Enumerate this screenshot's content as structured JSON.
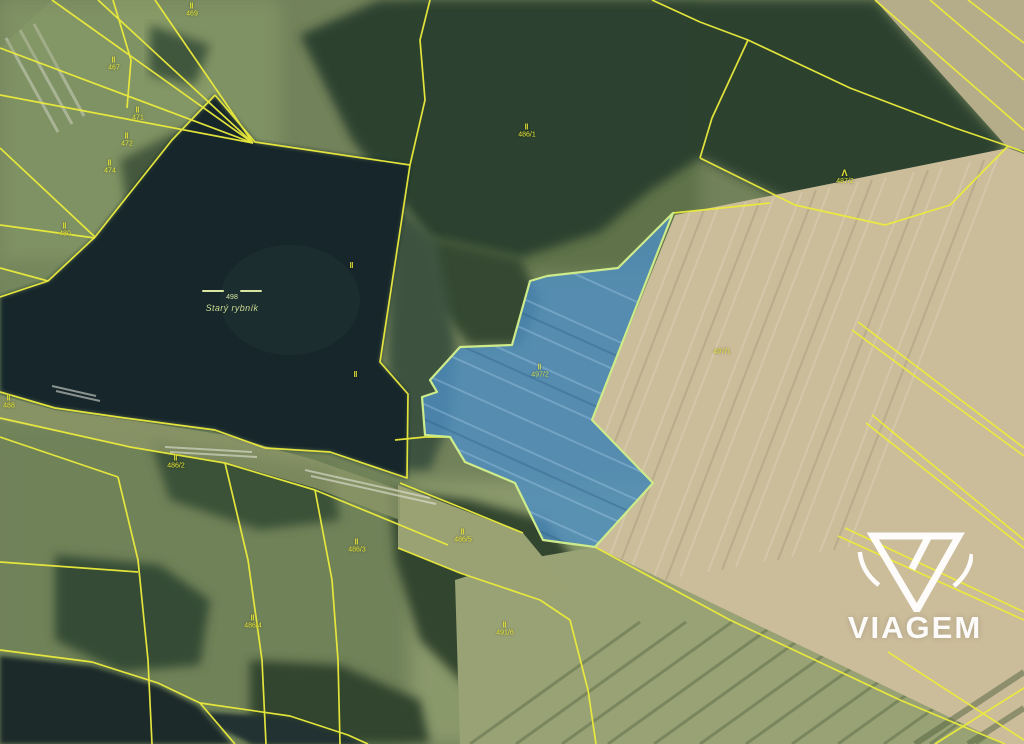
{
  "map": {
    "description": "aerial cadastral map with highlighted parcel",
    "watermark": {
      "brand": "VIAGEM"
    },
    "pond_label": {
      "number": "498",
      "name": "Starý rybník"
    },
    "highlighted_parcel": {
      "symbol": "‖",
      "number": "497/2",
      "fill": "#4d8fc4",
      "border": "#cdeb8a"
    },
    "colors": {
      "cadastral_line": "#ecec3c",
      "label_text": "#e8e838",
      "water": "#18272c",
      "field_beige": "#cbbc9a"
    },
    "labels": [
      {
        "symbol": "‖",
        "text": "469",
        "x": 192,
        "y": 10,
        "variant": ""
      },
      {
        "symbol": "‖",
        "text": "467",
        "x": 114,
        "y": 64,
        "variant": ""
      },
      {
        "symbol": "‖",
        "text": "471",
        "x": 138,
        "y": 114,
        "variant": ""
      },
      {
        "symbol": "‖",
        "text": "472",
        "x": 127,
        "y": 140,
        "variant": ""
      },
      {
        "symbol": "‖",
        "text": "474",
        "x": 110,
        "y": 167,
        "variant": ""
      },
      {
        "symbol": "‖",
        "text": "480",
        "x": 65,
        "y": 230,
        "variant": ""
      },
      {
        "symbol": "‖",
        "text": "488",
        "x": 9,
        "y": 402,
        "variant": ""
      },
      {
        "symbol": "‖",
        "text": "486/1",
        "x": 527,
        "y": 131,
        "variant": ""
      },
      {
        "symbol": "Λ",
        "text": "487/2",
        "x": 845,
        "y": 177,
        "variant": "forest"
      },
      {
        "symbol": "",
        "text": "497/1",
        "x": 722,
        "y": 352,
        "variant": ""
      },
      {
        "symbol": "‖",
        "text": "497/2",
        "x": 540,
        "y": 371,
        "variant": "on-blue"
      },
      {
        "symbol": "‖",
        "text": "",
        "x": 352,
        "y": 266,
        "variant": ""
      },
      {
        "symbol": "‖",
        "text": "",
        "x": 356,
        "y": 375,
        "variant": ""
      },
      {
        "symbol": "‖",
        "text": "486/2",
        "x": 176,
        "y": 462,
        "variant": ""
      },
      {
        "symbol": "‖",
        "text": "486/3",
        "x": 357,
        "y": 546,
        "variant": ""
      },
      {
        "symbol": "‖",
        "text": "486/5",
        "x": 463,
        "y": 536,
        "variant": ""
      },
      {
        "symbol": "‖",
        "text": "486/4",
        "x": 253,
        "y": 622,
        "variant": ""
      },
      {
        "symbol": "‖",
        "text": "491/6",
        "x": 505,
        "y": 629,
        "variant": ""
      }
    ]
  }
}
